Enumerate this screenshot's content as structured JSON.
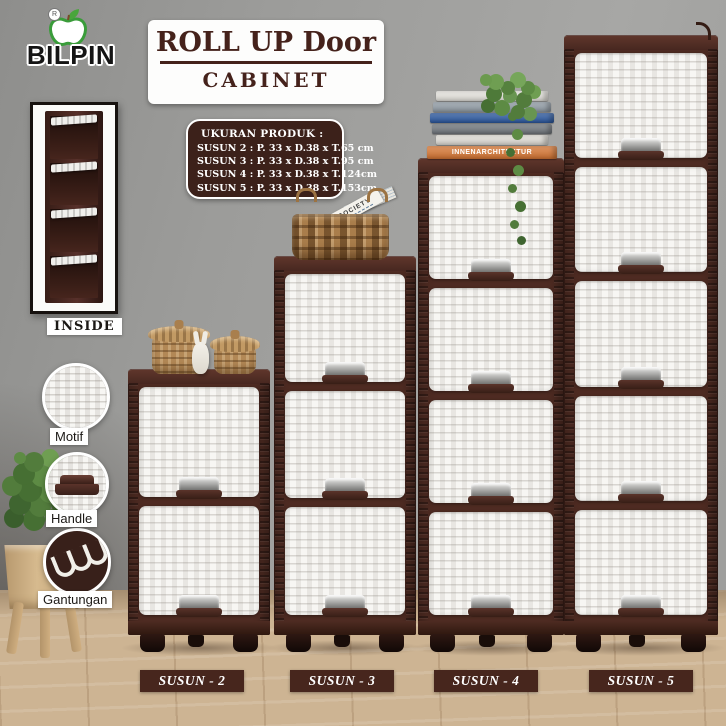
{
  "brand": {
    "name": "BILPIN",
    "registered": "R",
    "logo_icon": "apple-leaf-icon"
  },
  "title": {
    "line1": "ROLL UP Door",
    "line2": "CABINET"
  },
  "product_info": {
    "heading": "UKURAN  PRODUK :",
    "lines": [
      "SUSUN 2 : P. 33 x D.38 x T.65 cm",
      "SUSUN 3 : P. 33 x D.38 x T.95 cm",
      "SUSUN 4 : P. 33 x D.38 x T.124cm",
      "SUSUN 5 : P. 33 x D.38 x T.153cm"
    ]
  },
  "insets": {
    "inside_label": "INSIDE",
    "inside_compartments": 4,
    "features": [
      {
        "id": "motif",
        "label": "Motif"
      },
      {
        "id": "handle",
        "label": "Handle"
      },
      {
        "id": "gantungan",
        "label": "Gantungan"
      }
    ]
  },
  "cabinets": [
    {
      "id": "susun-2",
      "label": "SUSUN - 2",
      "drawers": 2
    },
    {
      "id": "susun-3",
      "label": "SUSUN - 3",
      "drawers": 3
    },
    {
      "id": "susun-4",
      "label": "SUSUN - 4",
      "drawers": 4
    },
    {
      "id": "susun-5",
      "label": "SUSUN - 5",
      "drawers": 5
    }
  ],
  "decor": {
    "magazine_text": "SOCIETY",
    "books": [
      {
        "color": "#efede7",
        "text": ""
      },
      {
        "color": "#97a2ac",
        "text": ""
      },
      {
        "color": "#2d5ca6",
        "text": ""
      },
      {
        "color": "#767c82",
        "text": ""
      },
      {
        "color": "#e9e6df",
        "text": ""
      },
      {
        "color": "#dd7a35",
        "text": "INNENARCHITEKTUR"
      }
    ]
  },
  "colors": {
    "frame_brown": "#4e2b22",
    "panel_brown": "#3c211a",
    "label_brown": "#47261d",
    "title_text": "#45221b",
    "wall_gray": "#9c9c9a",
    "floor_wood": "#cdb493",
    "drawer_white": "#f7f6f3",
    "basket_tan": "#b28856",
    "plant_green": "#5d8b44",
    "logo_green": "#3a9c3a",
    "book_orange": "#dd7a35",
    "book_blue": "#2d5ca6"
  }
}
